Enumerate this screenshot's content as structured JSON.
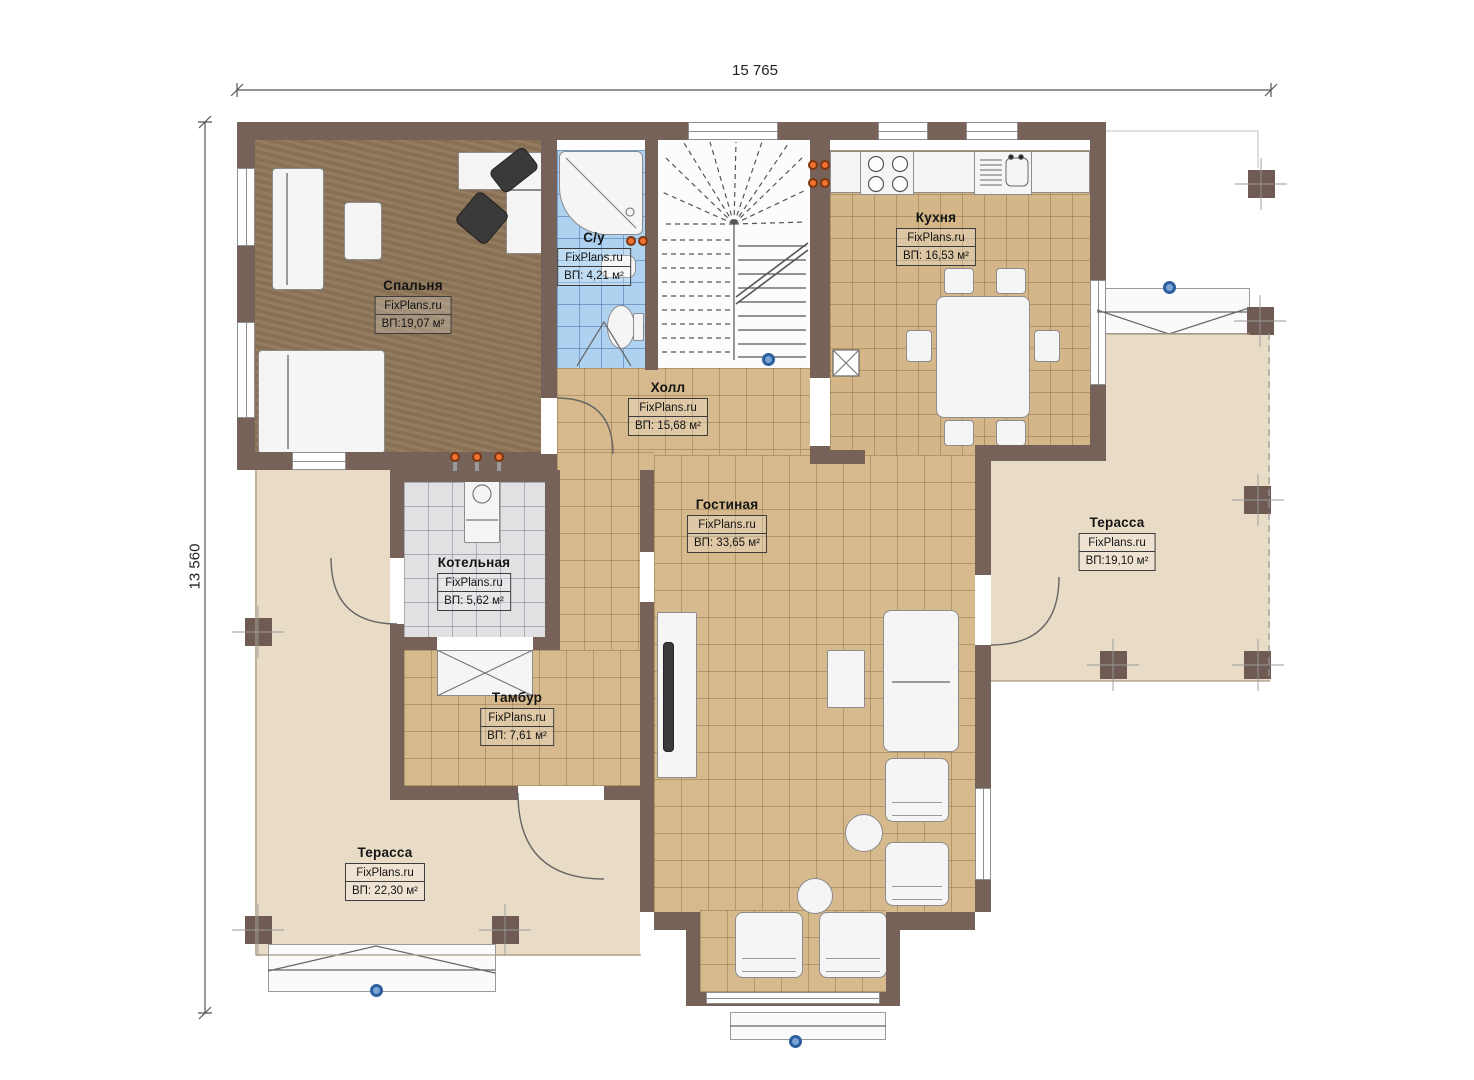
{
  "dimensions": {
    "top": "15 765",
    "left": "13 560"
  },
  "rooms": [
    {
      "key": "bedroom",
      "name": "Спальня",
      "brand": "FixPlans.ru",
      "area": "ВП:19,07 м²"
    },
    {
      "key": "bathroom",
      "name": "С/у",
      "brand": "FixPlans.ru",
      "area": "ВП: 4,21 м²"
    },
    {
      "key": "kitchen",
      "name": "Кухня",
      "brand": "FixPlans.ru",
      "area": "ВП: 16,53 м²"
    },
    {
      "key": "hall",
      "name": "Холл",
      "brand": "FixPlans.ru",
      "area": "ВП: 15,68 м²"
    },
    {
      "key": "living",
      "name": "Гостиная",
      "brand": "FixPlans.ru",
      "area": "ВП: 33,65 м²"
    },
    {
      "key": "boiler",
      "name": "Котельная",
      "brand": "FixPlans.ru",
      "area": "ВП: 5,62 м²"
    },
    {
      "key": "vestibule",
      "name": "Тамбур",
      "brand": "FixPlans.ru",
      "area": "ВП: 7,61 м²"
    },
    {
      "key": "terrace_right",
      "name": "Терасса",
      "brand": "FixPlans.ru",
      "area": "ВП:19,10 м²"
    },
    {
      "key": "terrace_left",
      "name": "Терасса",
      "brand": "FixPlans.ru",
      "area": "ВП: 22,30 м²"
    }
  ],
  "colors": {
    "wall": "#77625a",
    "wood_floor": "#8d7557",
    "tile_tan": "#d6b98c",
    "tile_gray": "#e1e1e4",
    "tile_blue": "#aed2f0",
    "terrace": "#e9dcc6",
    "radiator": "#f07030",
    "node_blue": "#2b5f9e"
  }
}
